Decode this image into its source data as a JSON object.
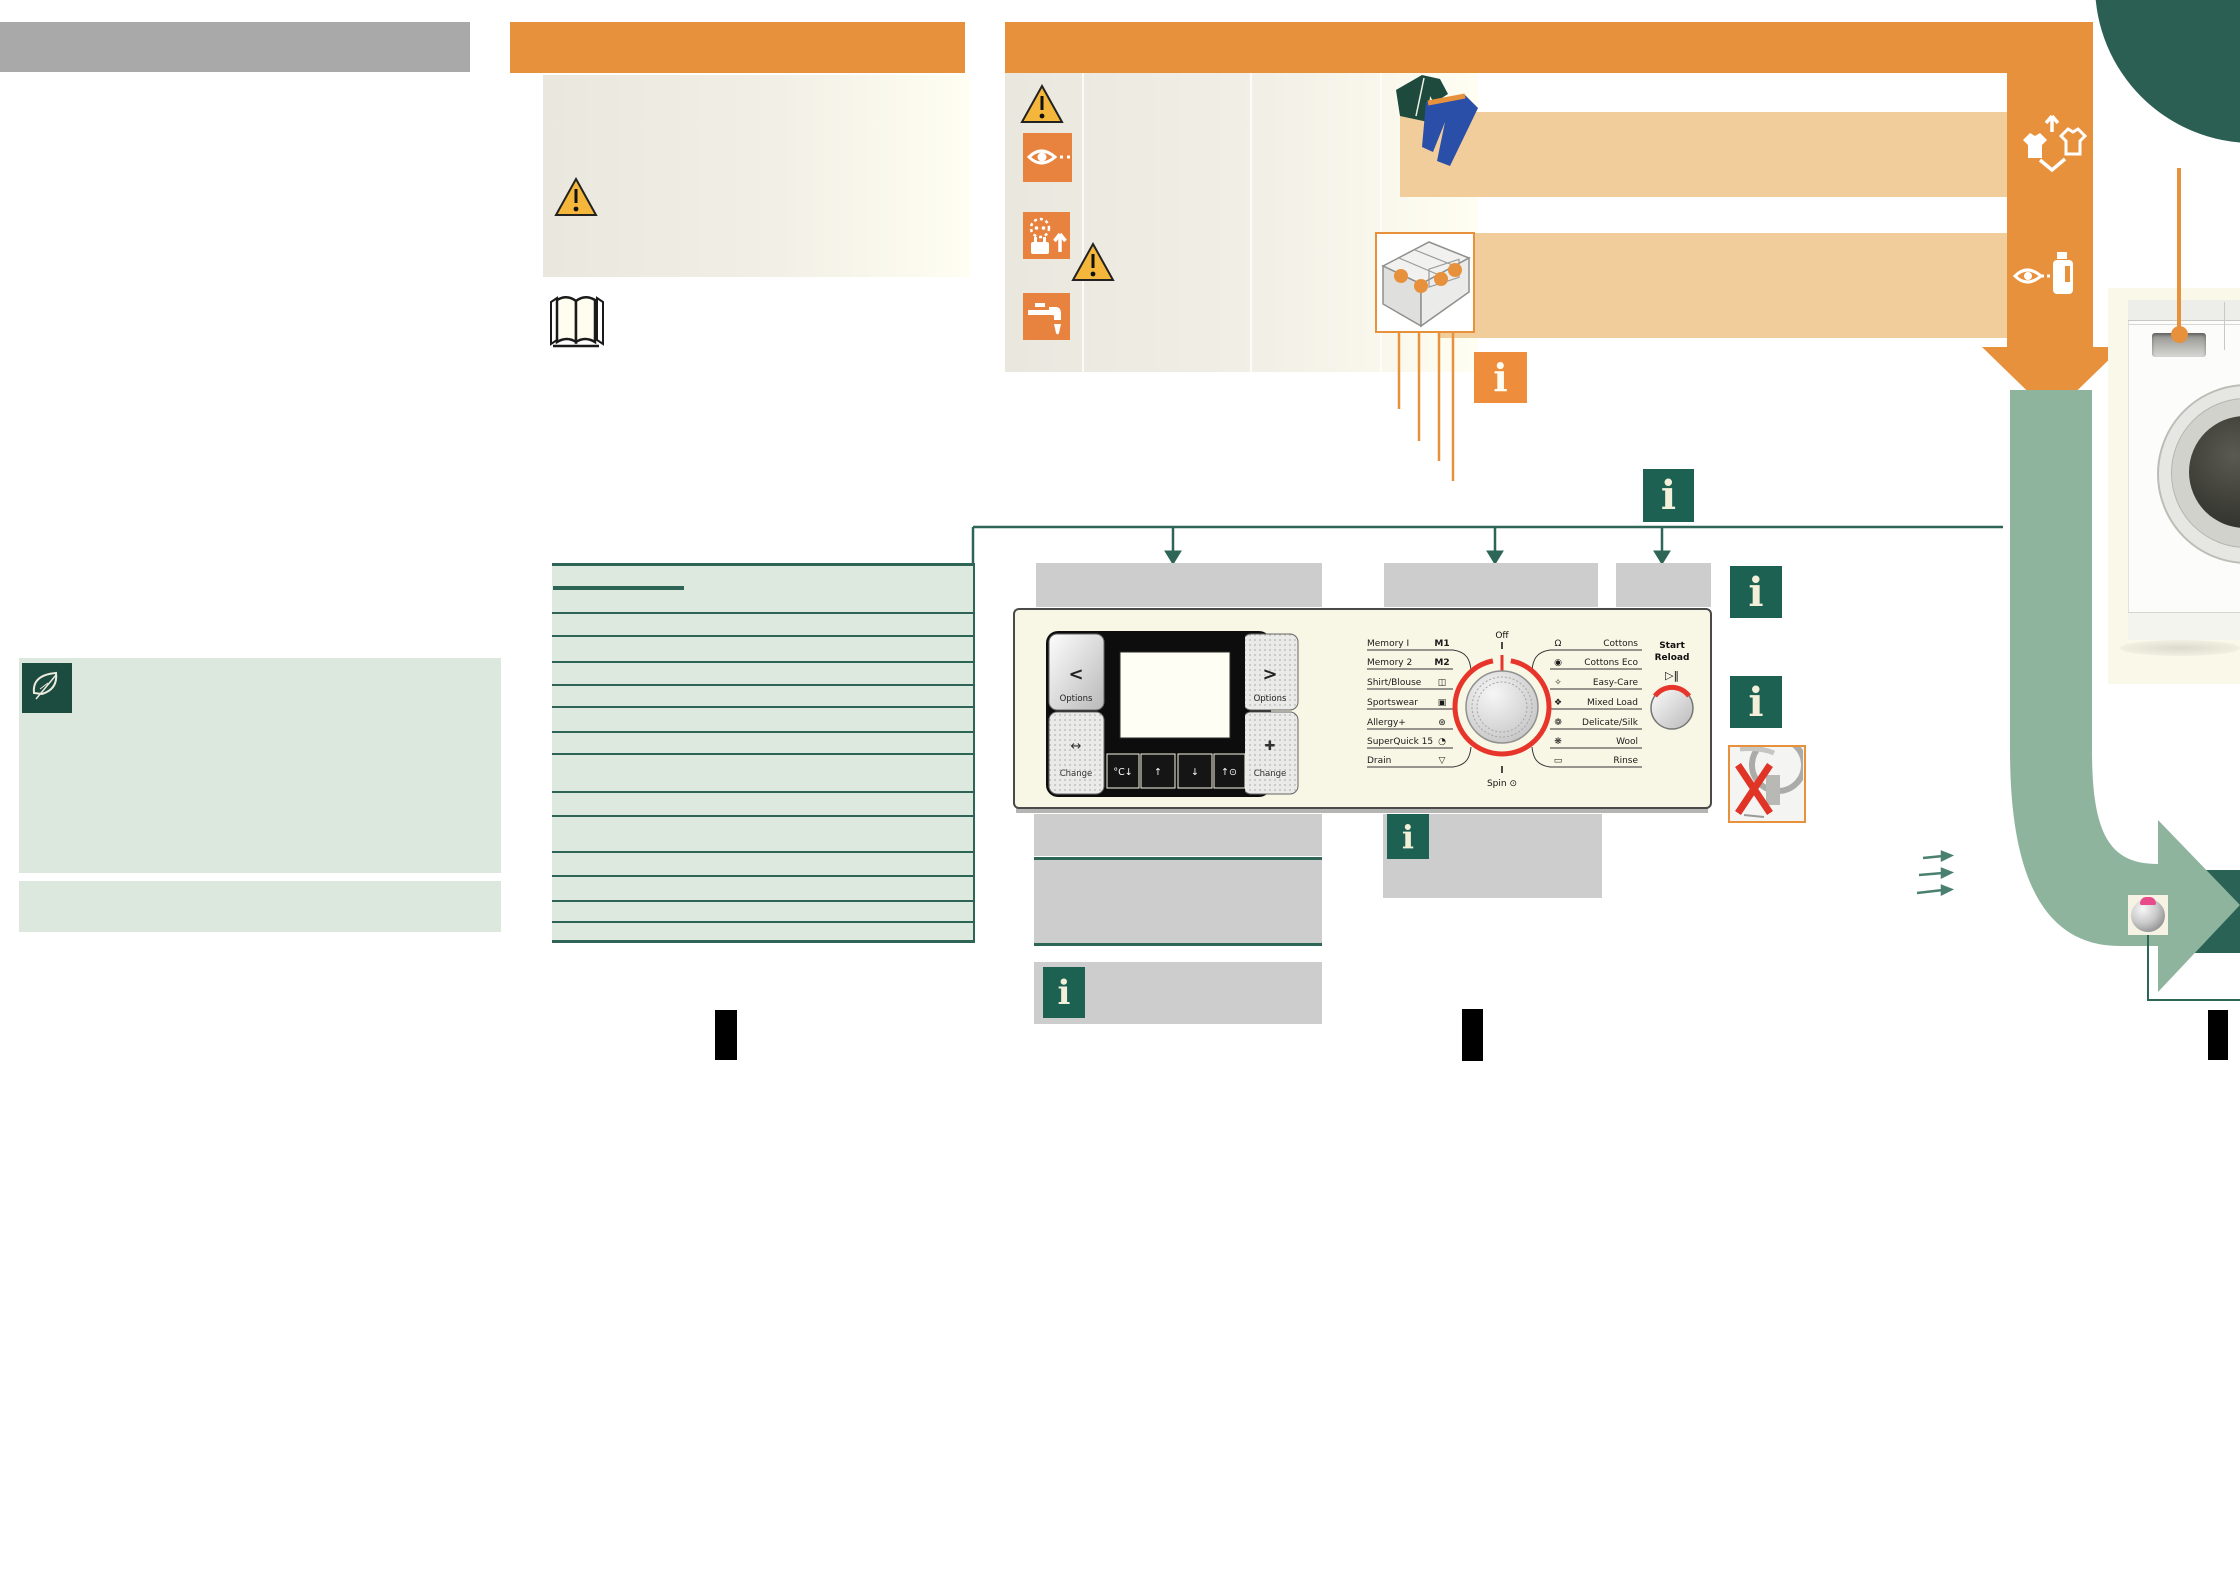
{
  "colors": {
    "accent_orange": "#E8913C",
    "icon_orange": "#E8833F",
    "tan_band": "#F2CD9C",
    "dark_green": "#1D6152",
    "table_green_line": "#2E6456",
    "table_green_bg": "#DDE8DE",
    "sage_arrow": "#8FB49E",
    "teal_circle": "#2C5F53",
    "gray_header": "#A9A9A9",
    "gray_label_box": "#CDCDCD",
    "panel_cream": "#F8F6E4",
    "dial_red": "#E8352B"
  },
  "info_badge_glyph": "i",
  "control_panel": {
    "chevron_left": "<",
    "chevron_right": ">",
    "options_left": "Options",
    "options_right": "Options",
    "change_left_icon": "↔",
    "change_right_icon": "✚",
    "change_left": "Change",
    "change_right": "Change",
    "keys": [
      "°C↓",
      "↑",
      "↓",
      "↑⊙"
    ],
    "off_label": "Off",
    "spin_label": "Spin ⊙",
    "start_label_1": "Start",
    "start_label_2": "Reload",
    "start_glyph": "▷‖",
    "programs_left": [
      {
        "label": "Memory I",
        "icon": "M1"
      },
      {
        "label": "Memory 2",
        "icon": "M2"
      },
      {
        "label": "Shirt/Blouse",
        "icon": "◫"
      },
      {
        "label": "Sportswear",
        "icon": "▣"
      },
      {
        "label": "Allergy+",
        "icon": "⊛"
      },
      {
        "label": "SuperQuick 15",
        "icon": "◔"
      },
      {
        "label": "Drain",
        "icon": "▽"
      }
    ],
    "programs_right": [
      {
        "label": "Cottons",
        "icon": "Ω"
      },
      {
        "label": "Cottons Eco",
        "icon": "◉"
      },
      {
        "label": "Easy-Care",
        "icon": "✧"
      },
      {
        "label": "Mixed Load",
        "icon": "❖"
      },
      {
        "label": "Delicate/Silk",
        "icon": "❁"
      },
      {
        "label": "Wool",
        "icon": "❋"
      },
      {
        "label": "Rinse",
        "icon": "▭"
      }
    ]
  }
}
